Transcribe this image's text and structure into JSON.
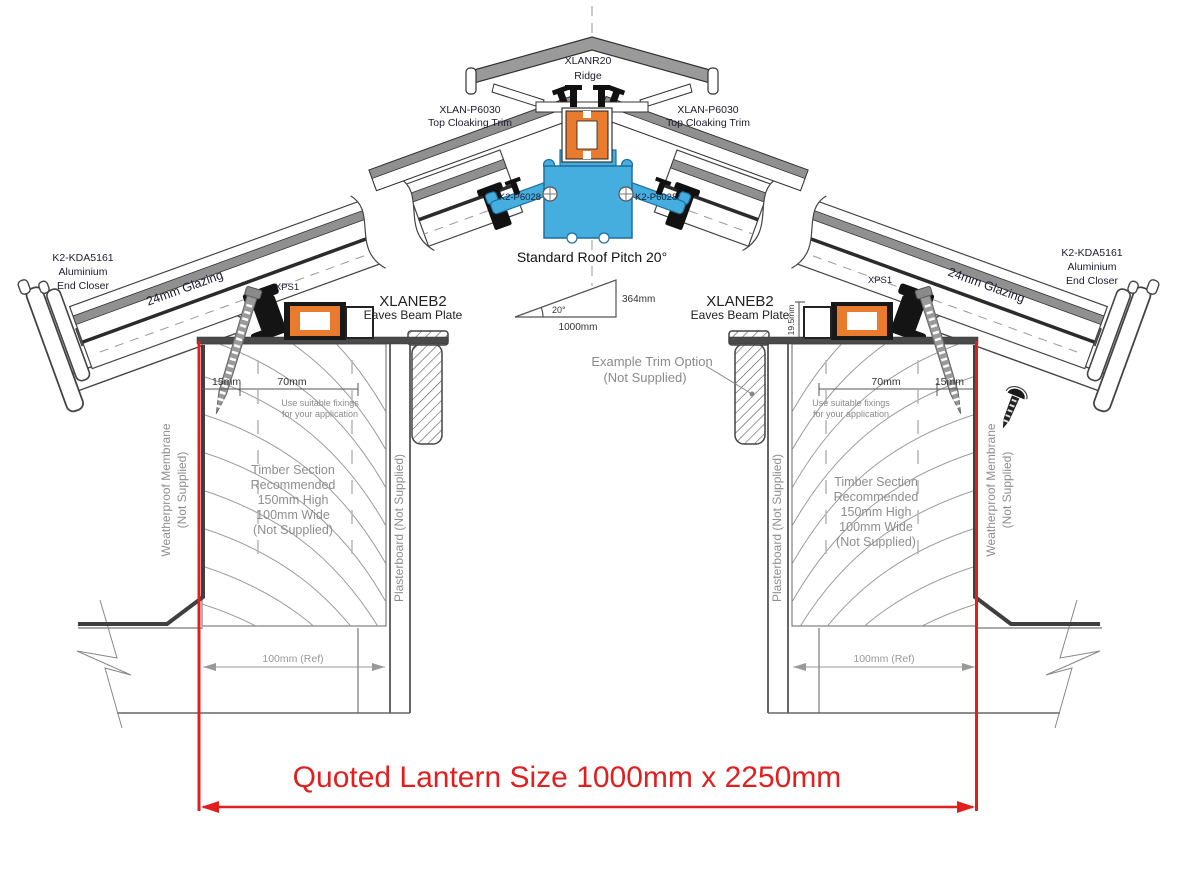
{
  "colors": {
    "accent_red": "#e02020",
    "profile_orange": "#e87b2e",
    "profile_blue": "#45aede",
    "profile_gray": "#909090",
    "label_dark": "#1c1c2e",
    "label_gray": "#8e8e8e"
  },
  "ridge": {
    "code": "XLANR20",
    "name": "Ridge"
  },
  "cloaking_left": {
    "code": "XLAN-P6030",
    "name": "Top Cloaking Trim"
  },
  "cloaking_right": {
    "code": "XLAN-P6030",
    "name": "Top Cloaking Trim"
  },
  "plate_left": {
    "code": "K2-P6028"
  },
  "plate_right": {
    "code": "K2-P6028"
  },
  "pitch": {
    "title": "Standard Roof Pitch 20°",
    "angle": "20°",
    "run": "1000mm",
    "rise": "364mm"
  },
  "closer_left": {
    "l1": "K2-KDA5161",
    "l2": "Aluminium",
    "l3": "End Closer"
  },
  "closer_right": {
    "l1": "K2-KDA5161",
    "l2": "Aluminium",
    "l3": "End Closer"
  },
  "glazing_left": {
    "label": "24mm Glazing"
  },
  "glazing_right": {
    "label": "24mm Glazing"
  },
  "xps_left": {
    "label": "XPS1"
  },
  "xps_right": {
    "label": "XPS1"
  },
  "eaves_left": {
    "code": "XLANEB2",
    "name": "Eaves Beam Plate"
  },
  "eaves_right": {
    "code": "XLANEB2",
    "name": "Eaves Beam Plate",
    "height": "19.5mm"
  },
  "dims_left": {
    "edge": "15mm",
    "fix": "70mm",
    "note1": "Use suitable fixings",
    "note2": "for your application",
    "ref": "100mm (Ref)"
  },
  "dims_right": {
    "edge": "15mm",
    "fix": "70mm",
    "note1": "Use suitable fixings",
    "note2": "for your application",
    "ref": "100mm (Ref)"
  },
  "trim_option": {
    "l1": "Example  Trim Option",
    "l2": "(Not Supplied)"
  },
  "timber_left": {
    "l1": "Timber Section",
    "l2": "Recommended",
    "l3": "150mm High",
    "l4": "100mm Wide",
    "l5": "(Not Supplied)"
  },
  "timber_right": {
    "l1": "Timber Section",
    "l2": "Recommended",
    "l3": "150mm High",
    "l4": "100mm Wide",
    "l5": "(Not Supplied)"
  },
  "membrane_left": {
    "l1": "Weatherproof Membrane",
    "l2": "(Not Supplied)"
  },
  "membrane_right": {
    "l1": "Weatherproof Membrane",
    "l2": "(Not Supplied)"
  },
  "plasterboard_left": {
    "label": "Plasterboard (Not Supplied)"
  },
  "plasterboard_right": {
    "label": "Plasterboard (Not Supplied)"
  },
  "quoted": {
    "label": "Quoted Lantern Size 1000mm x 2250mm"
  }
}
